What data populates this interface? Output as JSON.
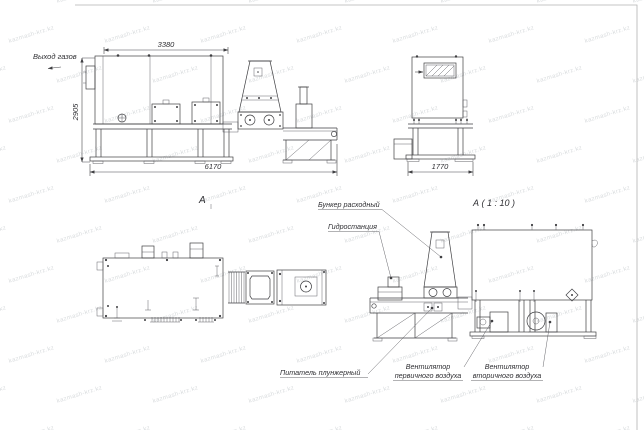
{
  "watermark": {
    "text": "kazmash-krz.kz",
    "color": "#d9dcde"
  },
  "drawing": {
    "labels": {
      "gas_outlet": "Выход газов",
      "view_a": "А",
      "view_a_detail": "А ( 1 : 10 )",
      "hopper": "Бункер расходный",
      "hydrostation": "Гидростанция",
      "feeder": "Питатель плунжерный",
      "primary_fan_line1": "Вентилятор",
      "primary_fan_line2": "первичного воздуха",
      "secondary_fan_line1": "Вентилятор",
      "secondary_fan_line2": "вторичного воздуха"
    },
    "dimensions": {
      "top_width": "3380",
      "left_height": "2905",
      "total_length": "6170",
      "end_width": "1770"
    },
    "colors": {
      "line": "#3f3f42",
      "dim_text": "#2f2f33",
      "sheet_border": "#b3b3b3",
      "background": "#ffffff"
    }
  }
}
